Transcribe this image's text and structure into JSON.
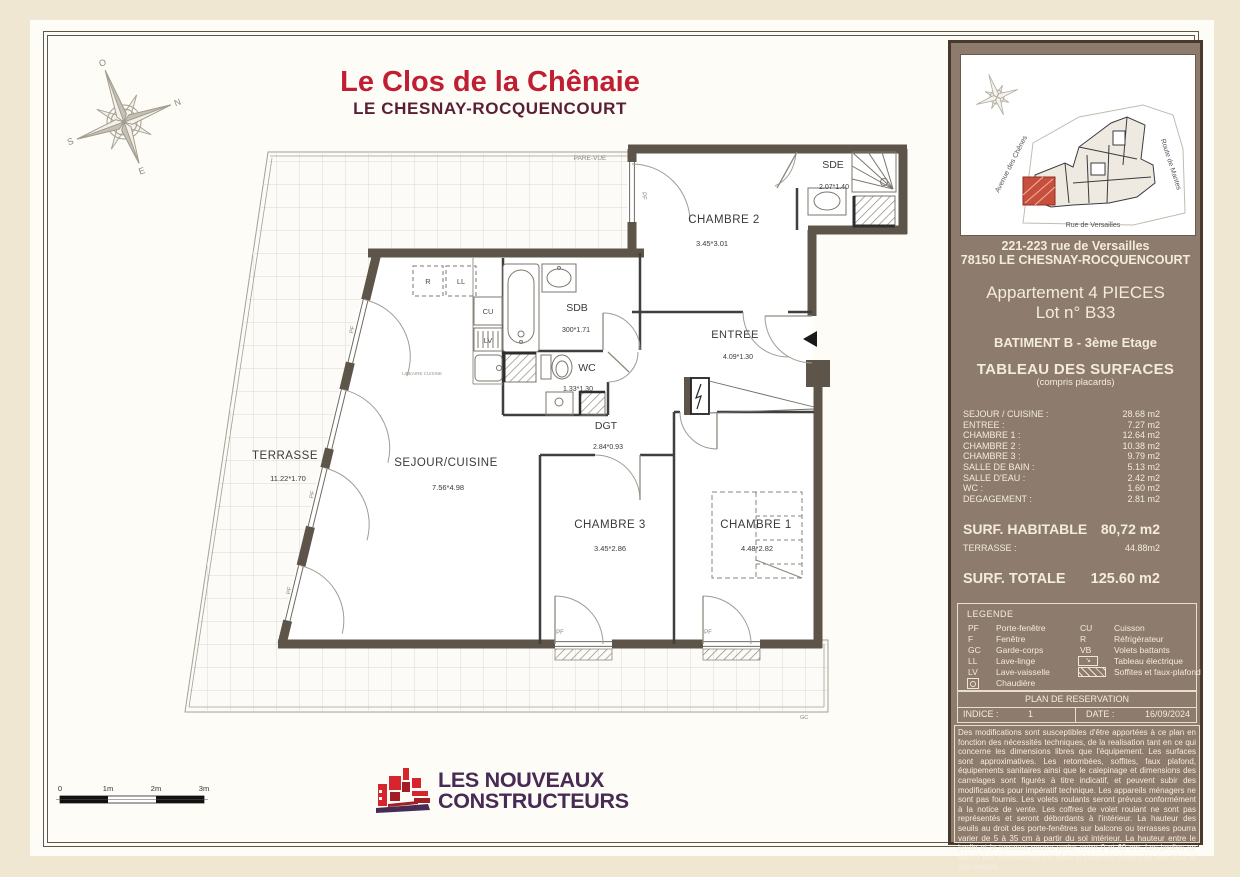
{
  "page": {
    "title": "Le Clos de la Chênaie",
    "subtitle": "LE CHESNAY-ROCQUENCOURT"
  },
  "plan": {
    "pare_vue_label": "PARE-VUE",
    "gc_label": "GC",
    "pf_label": "PF",
    "kitchen_note": "LINEAIRE CUISINE",
    "rooms": {
      "terrasse": {
        "name": "TERRASSE",
        "dims": "11.22*1.70"
      },
      "sejour": {
        "name": "SEJOUR/CUISINE",
        "dims": "7.56*4.98"
      },
      "chambre2": {
        "name": "CHAMBRE 2",
        "dims": "3.45*3.01"
      },
      "sde": {
        "name": "SDE",
        "dims": "2.07*1.40"
      },
      "sdb": {
        "name": "SDB",
        "dims": "300*1.71"
      },
      "wc": {
        "name": "WC",
        "dims": "1.33*1.30"
      },
      "entree": {
        "name": "ENTREE",
        "dims": "4.09*1.30"
      },
      "dgt": {
        "name": "DGT",
        "dims": "2.84*0.93"
      },
      "chambre3": {
        "name": "CHAMBRE 3",
        "dims": "3.45*2.86"
      },
      "chambre1": {
        "name": "CHAMBRE 1",
        "dims": "4.48*2.82"
      }
    },
    "appliances": {
      "r": "R",
      "ll": "LL",
      "cu": "CU",
      "lv": "LV"
    }
  },
  "scale_bar": {
    "labels": [
      "0",
      "1m",
      "2m",
      "3m"
    ]
  },
  "logo": {
    "line1": "LES NOUVEAUX",
    "line2": "CONSTRUCTEURS"
  },
  "sidebar": {
    "site_map": {
      "streets": [
        "Avenue des Chênes",
        "Route de Mantes",
        "Rue de Versailles"
      ]
    },
    "address_line1": "221-223 rue de Versailles",
    "address_line2": "78150 LE CHESNAY-ROCQUENCOURT",
    "apartment_type": "Appartement 4 PIECES",
    "lot": "Lot n° B33",
    "building": "BATIMENT B - 3ème Etage",
    "surfaces_title": "TABLEAU DES SURFACES",
    "surfaces_subtitle": "(compris placards)",
    "surfaces": [
      {
        "label": "SEJOUR / CUISINE :",
        "value": "28.68 m2"
      },
      {
        "label": "ENTREE :",
        "value": "7.27 m2"
      },
      {
        "label": "CHAMBRE 1 :",
        "value": "12.64 m2"
      },
      {
        "label": "CHAMBRE 2 :",
        "value": "10.38 m2"
      },
      {
        "label": "CHAMBRE 3 :",
        "value": "9.79 m2"
      },
      {
        "label": "SALLE DE BAIN :",
        "value": "5.13 m2"
      },
      {
        "label": "SALLE D'EAU :",
        "value": "2.42 m2"
      },
      {
        "label": "WC :",
        "value": "1.60 m2"
      },
      {
        "label": "DEGAGEMENT :",
        "value": "2.81 m2"
      }
    ],
    "habitable_label": "SURF. HABITABLE",
    "habitable_value": "80,72 m2",
    "terrasse_label": "TERRASSE :",
    "terrasse_value": "44.88m2",
    "totale_label": "SURF. TOTALE",
    "totale_value": "125.60 m2",
    "legend": {
      "title": "LEGENDE",
      "col1": [
        {
          "abbr": "PF",
          "label": "Porte-fenêtre"
        },
        {
          "abbr": "F",
          "label": "Fenêtre"
        },
        {
          "abbr": "GC",
          "label": "Garde-corps"
        },
        {
          "abbr": "LL",
          "label": "Lave-linge"
        },
        {
          "abbr": "LV",
          "label": "Lave-vaisselle"
        },
        {
          "abbr": "",
          "label": "Chaudière"
        }
      ],
      "col2": [
        {
          "abbr": "CU",
          "label": "Cuisson"
        },
        {
          "abbr": "R",
          "label": "Réfrigérateur"
        },
        {
          "abbr": "VB",
          "label": "Volets battants"
        },
        {
          "abbr": "",
          "label": "Tableau électrique"
        },
        {
          "abbr": "",
          "label": "Soffites et faux-plafond"
        }
      ]
    },
    "reservation": "PLAN DE RESERVATION",
    "indice_label": "INDICE :",
    "indice_value": "1",
    "date_label": "DATE :",
    "date_value": "16/09/2024",
    "disclaimer": "Des modifications sont susceptibles d'être apportées à ce plan en fonction des nécessités techniques, de la realisation tant en ce qui concerne les dimensions libres que l'équipement. Les surfaces sont approximatives. Les retombées, soffites, faux plafond, équipements sanitaires ainsi que le calepinage et dimensions des carrelages sont figurés à titre indicatif, et peuvent subir des modifications pour impératif technique. Les appareils ménagers ne sont pas fournis.  Les volets roulants seront prévus conformément à la notice de vente. Les coffres de volet roulant ne sont pas représentés et seront débordants à l'intérieur. La hauteur des seuils au droit des porte-fenêtres sur balcons ou terrasses pourra varier de 5 à 35 cm à partir du sol intérieur. La hauteur entre le jardin et la terrasse pourra varier entre 0 et 60 cm. Les jardins ne seront pas nécessairement plats et pourront comporter des talus et des pentes."
  },
  "colors": {
    "title_red": "#c01e32",
    "subtitle_maroon": "#5a1f36",
    "sidebar_brown": "#8d7b6d",
    "wall_brown": "#5d544a",
    "logo_purple": "#472b55",
    "logo_red": "#d6252e",
    "unit_highlight_red": "#c94f3d"
  }
}
